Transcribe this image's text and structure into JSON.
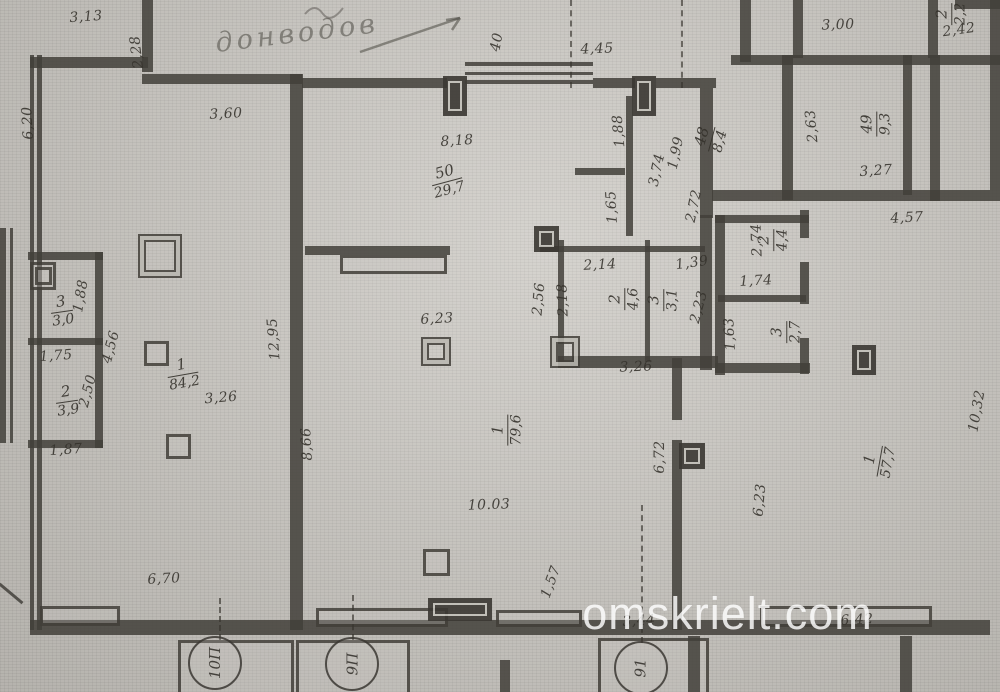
{
  "watermark": "omskrielt.com",
  "handwriting": {
    "note": "донводов"
  },
  "rooms": [
    {
      "n": "50",
      "a": "29,7",
      "x": 447,
      "y": 181,
      "r": -15
    },
    {
      "n": "1",
      "a": "84,2",
      "x": 183,
      "y": 374,
      "r": -10
    },
    {
      "n": "3",
      "a": "3,0",
      "x": 62,
      "y": 311,
      "r": -8
    },
    {
      "n": "2",
      "a": "3,9",
      "x": 67,
      "y": 401,
      "r": -8
    },
    {
      "n": "1",
      "a": "79,6",
      "x": 507,
      "y": 430,
      "r": -90
    },
    {
      "n": "48",
      "a": "8,4",
      "x": 711,
      "y": 139,
      "r": -75
    },
    {
      "n": "49",
      "a": "9,3",
      "x": 876,
      "y": 124,
      "r": -90
    },
    {
      "n": "2",
      "a": "4,6",
      "x": 624,
      "y": 299,
      "r": -90
    },
    {
      "n": "3",
      "a": "3,1",
      "x": 663,
      "y": 300,
      "r": -90
    },
    {
      "n": "2",
      "a": "4,4",
      "x": 773,
      "y": 240,
      "r": -90
    },
    {
      "n": "3",
      "a": "2,7",
      "x": 786,
      "y": 332,
      "r": -90
    },
    {
      "n": "1",
      "a": "57,7",
      "x": 879,
      "y": 461,
      "r": -80
    },
    {
      "n": "2",
      "a": "2,2",
      "x": 951,
      "y": 14,
      "r": -90
    }
  ],
  "dims": [
    {
      "t": "3,13",
      "x": 86,
      "y": 17,
      "r": -4
    },
    {
      "t": "2,28",
      "x": 137,
      "y": 52,
      "r": -97
    },
    {
      "t": "6,20",
      "x": 28,
      "y": 123,
      "r": -93
    },
    {
      "t": "3,60",
      "x": 226,
      "y": 114,
      "r": -3
    },
    {
      "t": "40",
      "x": 497,
      "y": 42,
      "r": -80
    },
    {
      "t": "4,45",
      "x": 597,
      "y": 49,
      "r": -2
    },
    {
      "t": "8,18",
      "x": 457,
      "y": 141,
      "r": -4
    },
    {
      "t": "3,00",
      "x": 838,
      "y": 25,
      "r": -2
    },
    {
      "t": "2,42",
      "x": 959,
      "y": 30,
      "r": -8
    },
    {
      "t": "1,88",
      "x": 619,
      "y": 131,
      "r": -95
    },
    {
      "t": "1,65",
      "x": 612,
      "y": 207,
      "r": -93
    },
    {
      "t": "1,99",
      "x": 676,
      "y": 153,
      "r": -78
    },
    {
      "t": "3,74",
      "x": 657,
      "y": 170,
      "r": -78
    },
    {
      "t": "2,72",
      "x": 694,
      "y": 206,
      "r": -78
    },
    {
      "t": "2,63",
      "x": 812,
      "y": 126,
      "r": -95
    },
    {
      "t": "3,27",
      "x": 876,
      "y": 171,
      "r": -4
    },
    {
      "t": "4,57",
      "x": 907,
      "y": 218,
      "r": -3
    },
    {
      "t": "2,74",
      "x": 757,
      "y": 240,
      "r": -92
    },
    {
      "t": "1,74",
      "x": 756,
      "y": 281,
      "r": -3
    },
    {
      "t": "1,63",
      "x": 730,
      "y": 334,
      "r": -93
    },
    {
      "t": "2,14",
      "x": 600,
      "y": 265,
      "r": -3
    },
    {
      "t": "1,39",
      "x": 692,
      "y": 263,
      "r": -8
    },
    {
      "t": "2,18",
      "x": 563,
      "y": 300,
      "r": -92
    },
    {
      "t": "2,56",
      "x": 539,
      "y": 299,
      "r": -85
    },
    {
      "t": "2,23",
      "x": 699,
      "y": 307,
      "r": -75
    },
    {
      "t": "3,26",
      "x": 636,
      "y": 367,
      "r": -2
    },
    {
      "t": "12,95",
      "x": 274,
      "y": 339,
      "r": -94
    },
    {
      "t": "1,88",
      "x": 81,
      "y": 296,
      "r": -80
    },
    {
      "t": "4,56",
      "x": 111,
      "y": 347,
      "r": -75
    },
    {
      "t": "1,75",
      "x": 56,
      "y": 356,
      "r": -4
    },
    {
      "t": "2,50",
      "x": 88,
      "y": 391,
      "r": -75
    },
    {
      "t": "1,87",
      "x": 66,
      "y": 450,
      "r": -4
    },
    {
      "t": "3,26",
      "x": 221,
      "y": 398,
      "r": -5
    },
    {
      "t": "6,23",
      "x": 437,
      "y": 319,
      "r": -3
    },
    {
      "t": "8,66",
      "x": 307,
      "y": 444,
      "r": -93
    },
    {
      "t": "6,72",
      "x": 660,
      "y": 457,
      "r": -90
    },
    {
      "t": "6,23",
      "x": 760,
      "y": 500,
      "r": -85
    },
    {
      "t": "10,32",
      "x": 977,
      "y": 411,
      "r": -80
    },
    {
      "t": "10.03",
      "x": 489,
      "y": 505,
      "r": -2
    },
    {
      "t": "1,57",
      "x": 551,
      "y": 582,
      "r": -70
    },
    {
      "t": "6,70",
      "x": 164,
      "y": 579,
      "r": -3
    },
    {
      "t": "3,44",
      "x": 639,
      "y": 621,
      "r": -3
    },
    {
      "t": "6,42",
      "x": 857,
      "y": 620,
      "r": -3
    }
  ],
  "axes": [
    {
      "t": "10П",
      "x": 215,
      "y": 663
    },
    {
      "t": "9П",
      "x": 352,
      "y": 664
    },
    {
      "t": "91",
      "x": 641,
      "y": 668
    }
  ]
}
